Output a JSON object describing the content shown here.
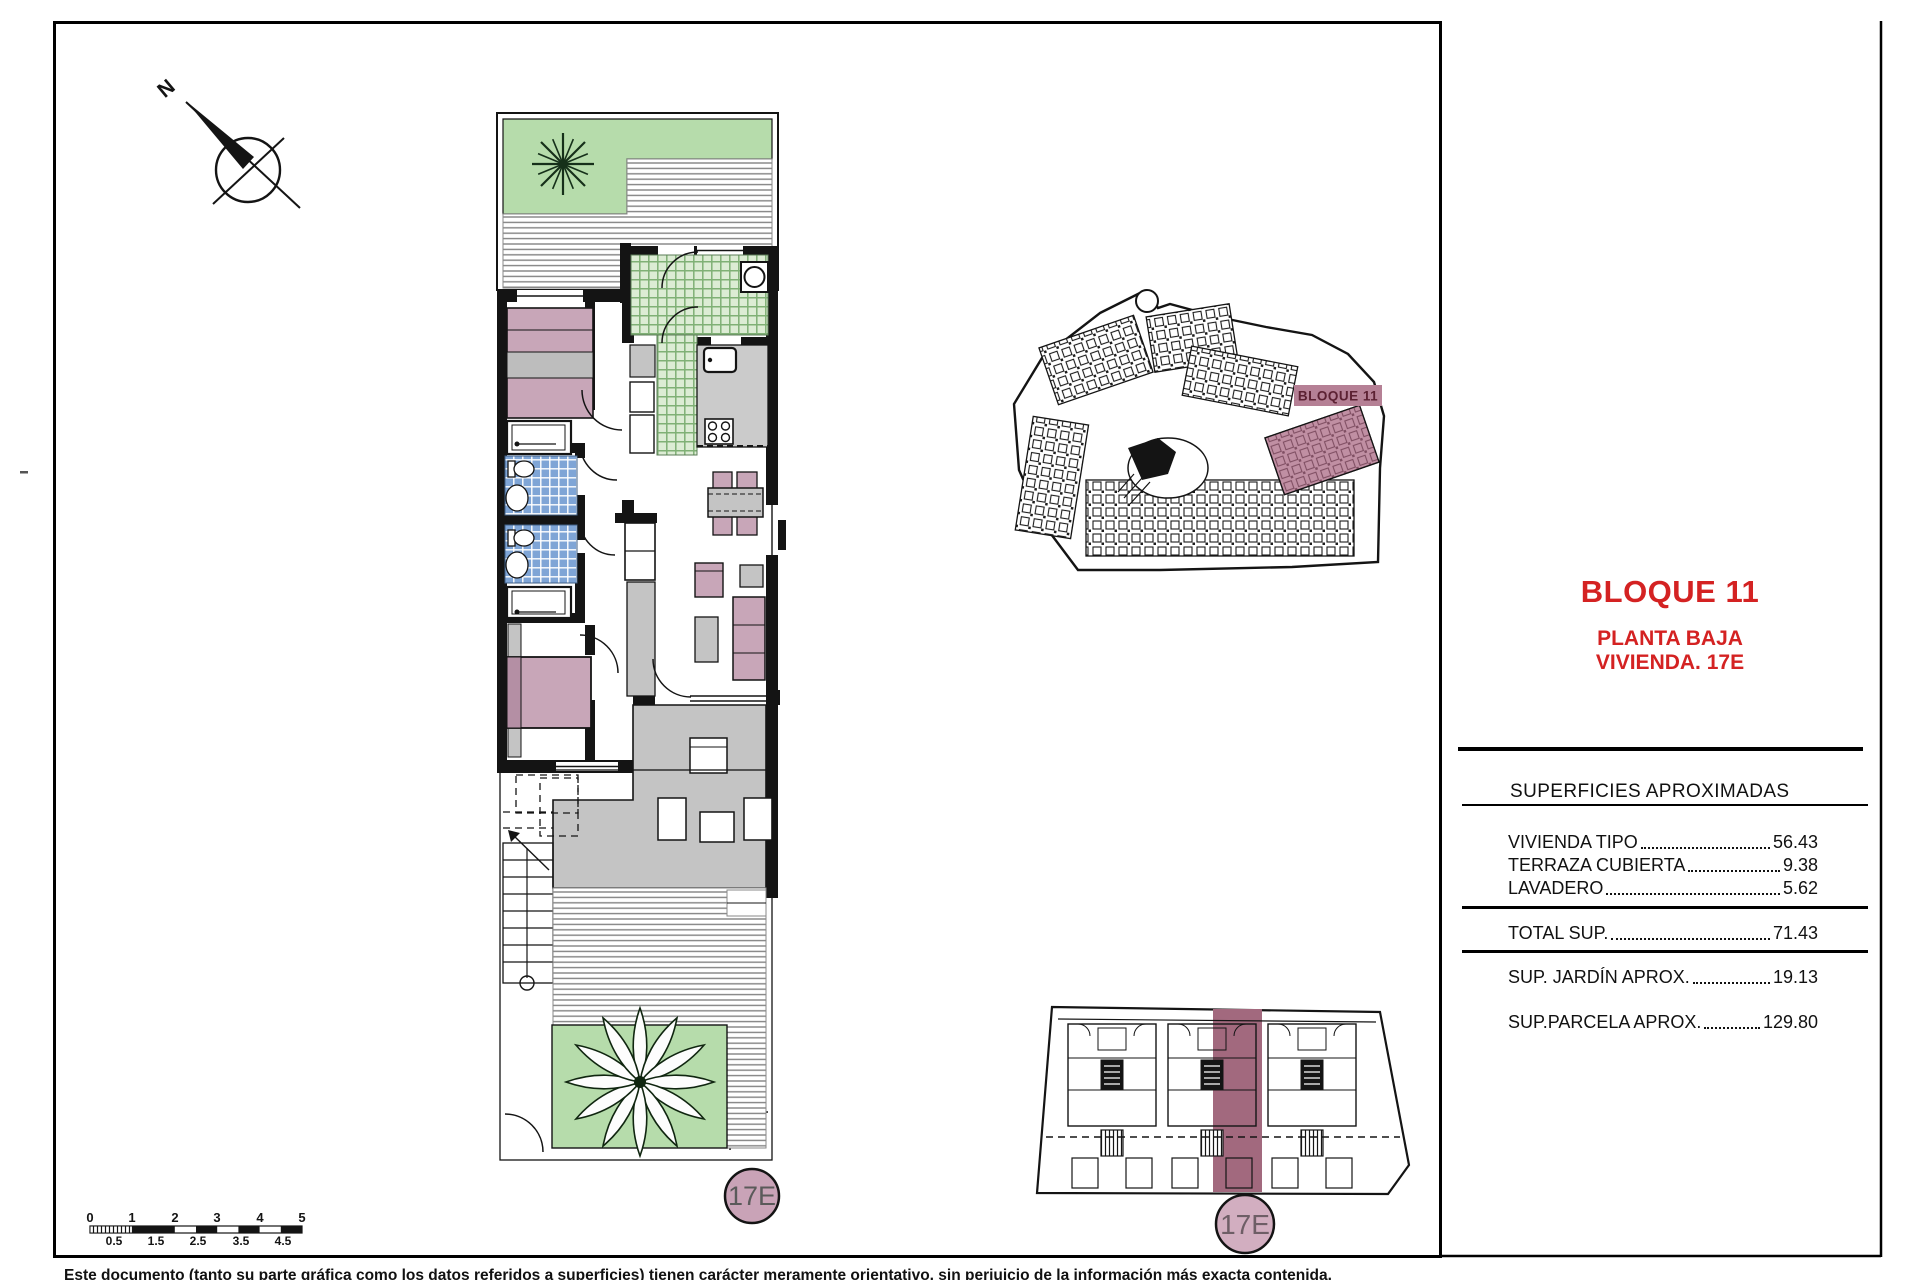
{
  "compass": {
    "north_label": "N"
  },
  "panel": {
    "title": "BLOQUE 11",
    "subtitle1": "PLANTA BAJA",
    "subtitle2": "VIVIENDA. 17E"
  },
  "surfaces": {
    "header": "SUPERFICIES APROXIMADAS",
    "rows": [
      {
        "label": "VIVIENDA TIPO",
        "value": "56.43"
      },
      {
        "label": "TERRAZA CUBIERTA",
        "value": "9.38"
      },
      {
        "label": "LAVADERO",
        "value": "5.62"
      }
    ],
    "total": {
      "label": "TOTAL SUP.",
      "value": "71.43"
    },
    "extras": [
      {
        "label": "SUP. JARDÍN APROX.",
        "value": "19.13"
      },
      {
        "label": "SUP.PARCELA APROX.",
        "value": "129.80"
      }
    ]
  },
  "site_plan": {
    "block_label": "BLOQUE 11",
    "highlight_color": "#a8647f"
  },
  "unit_badge": {
    "label": "17E",
    "color": "#c9a3b7"
  },
  "scalebar": {
    "top": [
      "0",
      "1",
      "2",
      "3",
      "4",
      "5"
    ],
    "bottom": [
      "0.5",
      "1.5",
      "2.5",
      "3.5",
      "4.5"
    ]
  },
  "disclaimer": "Este documento (tanto su parte gráfica como los datos referidos a superficies) tienen carácter meramente orientativo, sin perjuicio de la información más exacta contenida.",
  "colors": {
    "accent_red": "#d42222",
    "tile_green": "#dcecd4",
    "tile_blue": "#7fa5d6",
    "furniture_pink": "#c8a6b8"
  }
}
